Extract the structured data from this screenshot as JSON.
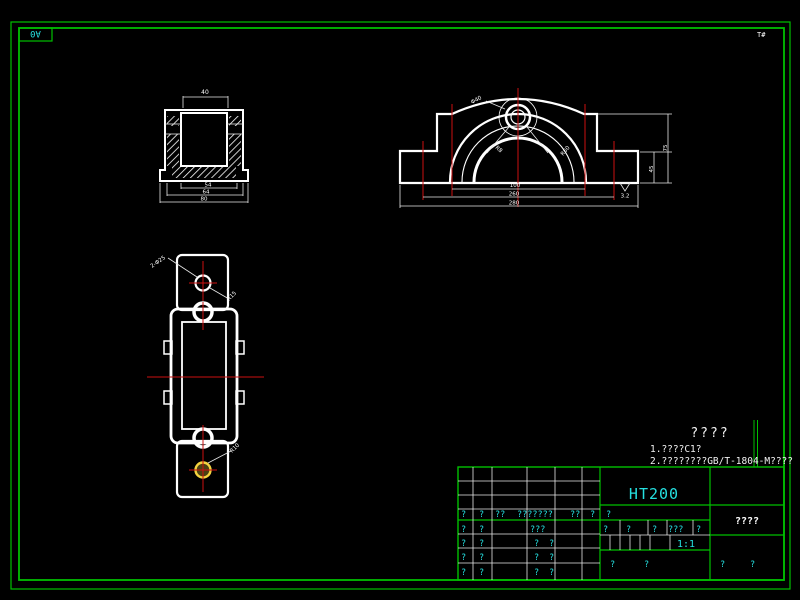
{
  "colors": {
    "background": "#000000",
    "border_green": "#00c000",
    "line_white": "#ffffff",
    "centerline_red": "#cc1111",
    "text_cyan": "#25e0e0",
    "label_red": "#e04040",
    "highlight_yellow": "#f5d33f"
  },
  "frame": {
    "size_label": "A0",
    "corner_mark": "T#"
  },
  "notes": {
    "title": "????",
    "line1": "1.????C1?",
    "line2": "2.????????GB/T-1804-M????"
  },
  "section_view": {
    "dim_top": "40",
    "dim_inner": "54",
    "dim_mid": "64",
    "dim_outer": "80"
  },
  "front_view": {
    "dim_bolt_span": "100",
    "dim_slot_span": "260",
    "dim_base": "280",
    "dim_height_inner": "45",
    "dim_height_outer": "75",
    "label_bore": "Φ40",
    "label_fillet": "R8",
    "label_radius": "R60",
    "roughness": "3.2"
  },
  "top_view": {
    "label_holes": "2-Φ25",
    "label_neck_radius": "R15",
    "label_lug_radius": "R10"
  },
  "title_block": {
    "material": "HT200",
    "scale": "1:1",
    "part_name": "????",
    "header_row": [
      "?",
      "?",
      "??",
      "???????",
      "??",
      "?"
    ],
    "mid_mark": "?",
    "rows": [
      [
        "?",
        "?",
        "???",
        ""
      ],
      [
        "?",
        "?",
        "?",
        "?"
      ],
      [
        "?",
        "?",
        "?",
        "?"
      ],
      [
        "?",
        "?",
        "?",
        "?"
      ]
    ],
    "mid_row": [
      "?",
      "?",
      "?",
      "???",
      "?"
    ],
    "bottom_left": [
      "?",
      "?"
    ],
    "bottom_right": [
      "?",
      "?"
    ]
  }
}
